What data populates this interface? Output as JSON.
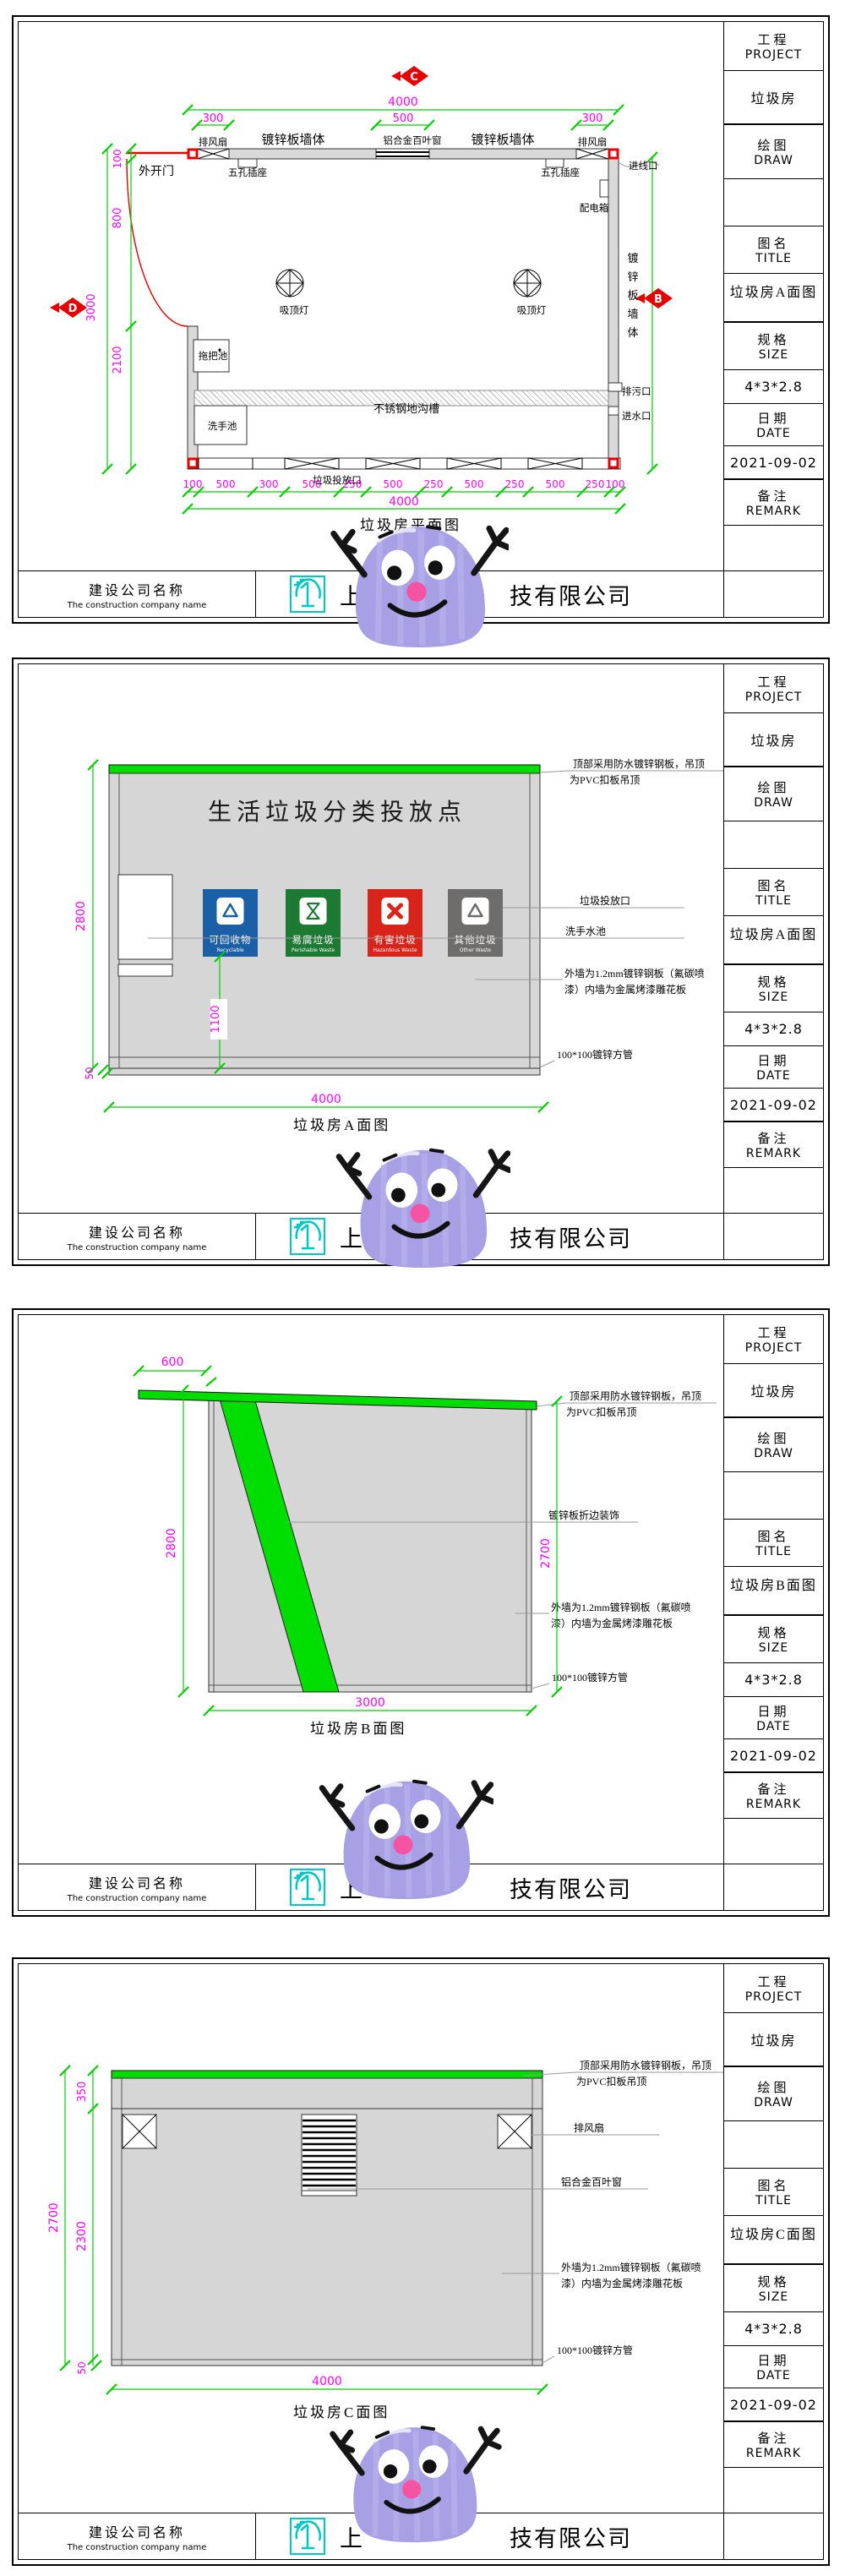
{
  "title_block": {
    "project_label": "工程",
    "project_en": "PROJECT",
    "project_value": "垃圾房",
    "draw_label": "绘图",
    "draw_en": "DRAW",
    "name_label": "图名",
    "name_en": "TITLE",
    "size_label": "规格",
    "size_en": "SIZE",
    "size_value": "4*3*2.8",
    "date_label": "日期",
    "date_en": "DATE",
    "date_value": "2021-09-02",
    "remark_label": "备注",
    "remark_en": "REMARK"
  },
  "footer": {
    "label_cn": "建设公司名称",
    "label_en": "The construction company name",
    "company_start": "上",
    "company_end": "技有限公司"
  },
  "colors": {
    "dim_green": "#00cf00",
    "dim_magenta": "#ff00ff",
    "marker_red": "#e60000",
    "roof_green": "#00dd00",
    "wall_grey": "#d9d9d9",
    "bin_blue": "#1b5fa6",
    "bin_green": "#1d7a33",
    "bin_red": "#d8251c",
    "bin_grey": "#6f6c6c",
    "logo_cyan": "#00c7c7",
    "mascot_purple": "#a7a0e4",
    "mascot_nose": "#f653a2"
  },
  "panels": [
    {
      "title_value": "垃圾房A面图",
      "caption": "垃圾房平面图",
      "markers": {
        "top": "C",
        "left": "D",
        "right": "B"
      },
      "labels": {
        "door": "外开门",
        "fan": "排风扇",
        "wall": "镀锌板墙体",
        "wall_v": [
          "镀",
          "锌",
          "板",
          "墙",
          "体"
        ],
        "louver": "铝合金百叶窗",
        "socket": "五孔插座",
        "inlet_line": "进线口",
        "dist_box": "配电箱",
        "lamp": "吸顶灯",
        "mop_sink": "拖把池",
        "trench": "不锈钢地沟槽",
        "wash_sink": "洗手池",
        "drop_opening": "垃圾投放口",
        "sewage": "排污口",
        "water_inlet": "进水口"
      },
      "dims": {
        "top_total": "4000",
        "seg_left": "300",
        "seg_mid": "500",
        "seg_right": "300",
        "left_a": "100",
        "left_b": "800",
        "left_c": "2100",
        "left_total": "3000",
        "bottom": [
          "100",
          "500",
          "300",
          "500",
          "250",
          "500",
          "250",
          "500",
          "250",
          "500",
          "250",
          "100"
        ],
        "bottom_total": "4000"
      }
    },
    {
      "title_value": "垃圾房A面图",
      "caption": "垃圾房A面图",
      "sign": "生活垃圾分类投放点",
      "bins": [
        {
          "label": "可回收物",
          "en": "Recyclable"
        },
        {
          "label": "易腐垃圾",
          "en": "Perishable Waste"
        },
        {
          "label": "有害垃圾",
          "en": "Hazardous Waste"
        },
        {
          "label": "其他垃圾",
          "en": "Other Waste"
        }
      ],
      "notes": {
        "roof_1": "顶部采用防水镀锌钢板，吊顶",
        "roof_2": "为PVC扣板吊顶",
        "drop": "垃圾投放口",
        "sink": "洗手水池",
        "wall_1": "外墙为1.2mm镀锌钢板（氟碳喷",
        "wall_2": "漆）内墙为金属烤漆雕花板",
        "tube": "100*100镀锌方管"
      },
      "dims": {
        "left": "2800",
        "inner": "1100",
        "base": "50",
        "bottom": "4000"
      }
    },
    {
      "title_value": "垃圾房B面图",
      "caption": "垃圾房B面图",
      "notes": {
        "roof_1": "顶部采用防水镀锌钢板，吊顶",
        "roof_2": "为PVC扣板吊顶",
        "fold": "镀锌板折边装饰",
        "wall_1": "外墙为1.2mm镀锌钢板（氟碳喷",
        "wall_2": "漆）内墙为金属烤漆雕花板",
        "tube": "100*100镀锌方管"
      },
      "dims": {
        "overhang": "600",
        "left": "2800",
        "right": "2700",
        "bottom": "3000"
      }
    },
    {
      "title_value": "垃圾房C面图",
      "caption": "垃圾房C面图",
      "notes": {
        "roof_1": "顶部采用防水镀锌钢板，吊顶",
        "roof_2": "为PVC扣板吊顶",
        "fan": "排风扇",
        "louver": "铝合金百叶窗",
        "wall_1": "外墙为1.2mm镀锌钢板（氟碳喷",
        "wall_2": "漆）内墙为金属烤漆雕花板",
        "tube": "100*100镀锌方管"
      },
      "dims": {
        "top": "350",
        "mid": "2300",
        "left_total": "2700",
        "base": "50",
        "bottom": "4000"
      }
    }
  ]
}
